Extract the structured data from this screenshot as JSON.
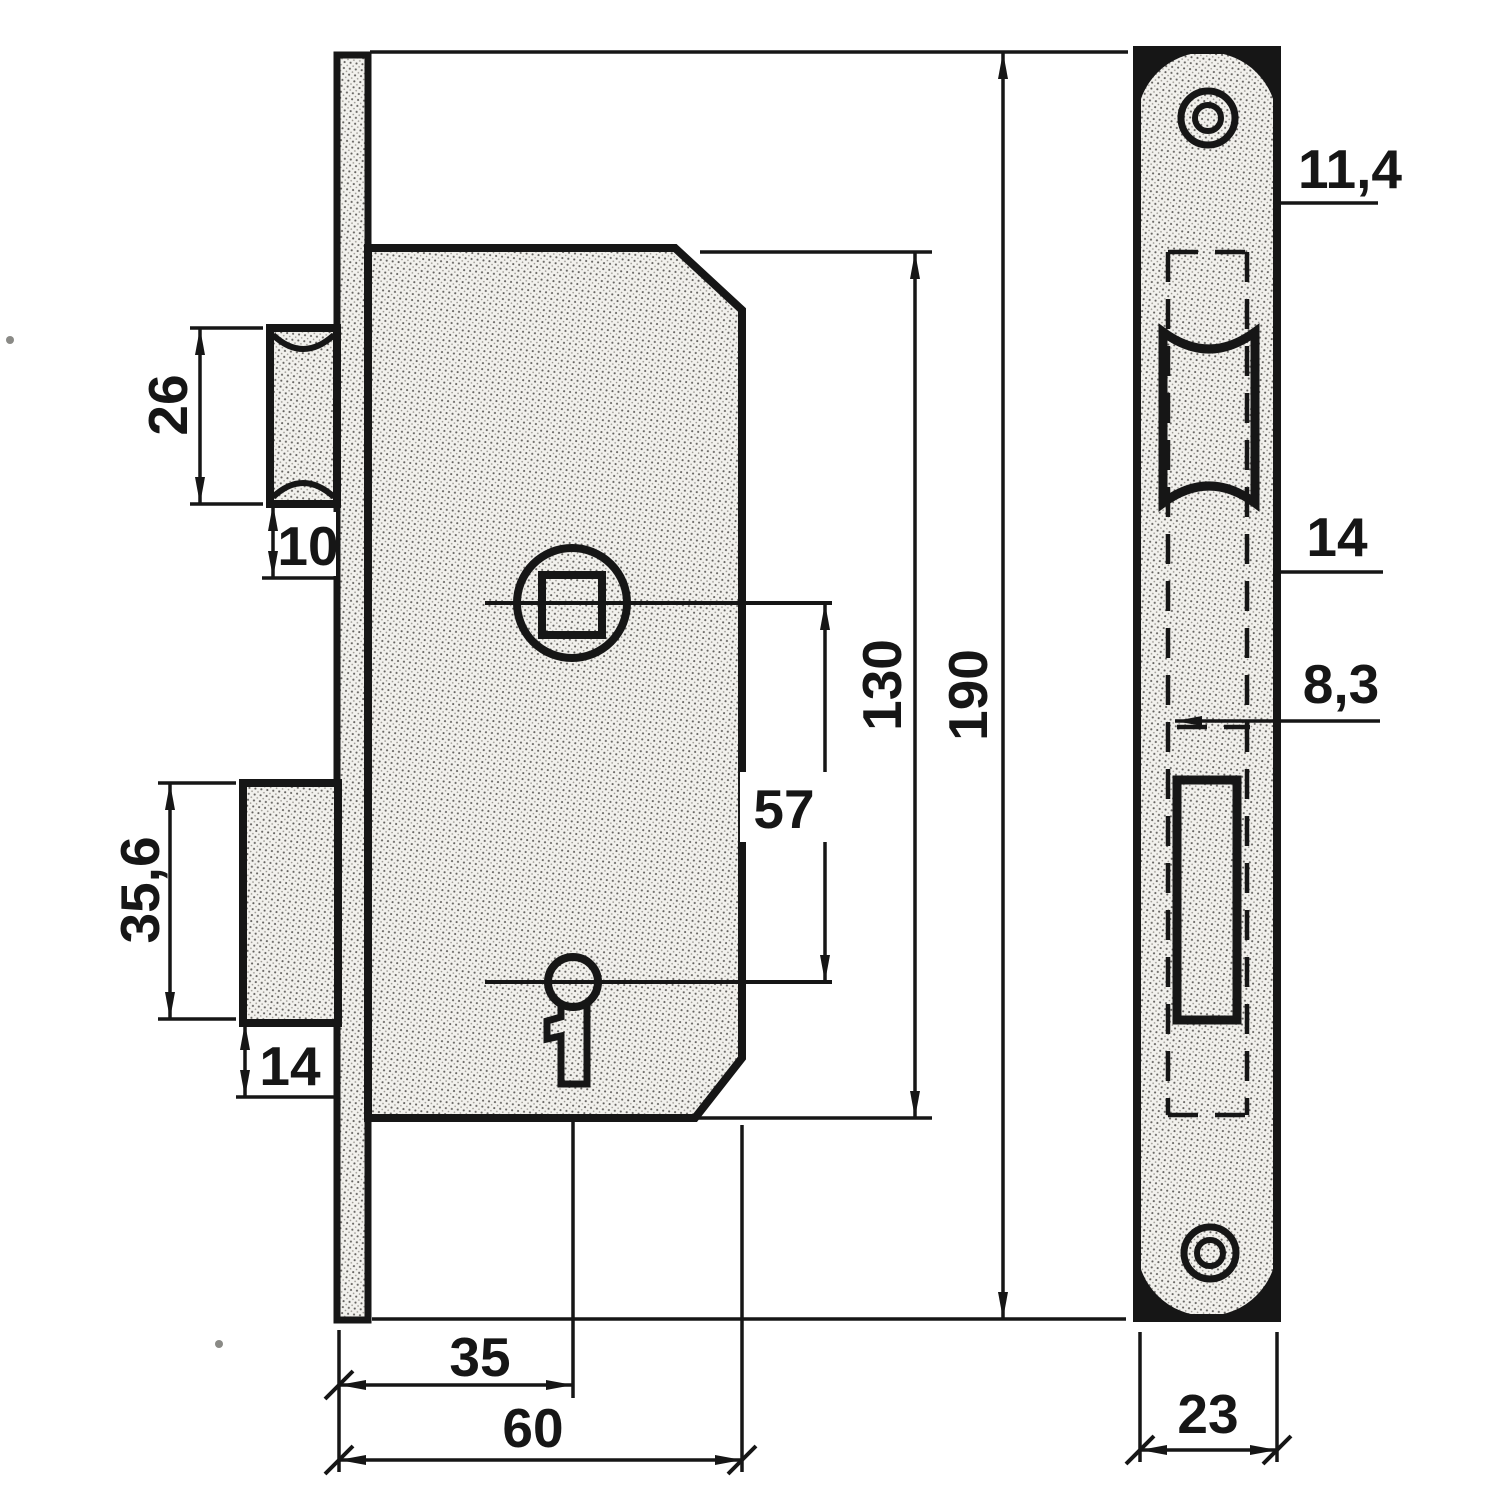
{
  "drawing": {
    "kind": "technical drawing",
    "subject": "mortise lock with faceplate",
    "line_color": "#161616",
    "background": "#ffffff"
  },
  "side_view": {
    "name": "lock case side view",
    "dims": {
      "latch_height": "26",
      "latch_below": "10",
      "bolt_height": "35,6",
      "bolt_below": "14",
      "follower_to_keyhole": "57",
      "case_height": "130",
      "plate_length": "190",
      "backset": "35",
      "case_depth": "60"
    }
  },
  "front_view": {
    "name": "faceplate front view",
    "dims": {
      "plate_top": "11,4",
      "latch_cut": "14",
      "bolt_cut": "8,3",
      "plate_width": "23"
    }
  }
}
